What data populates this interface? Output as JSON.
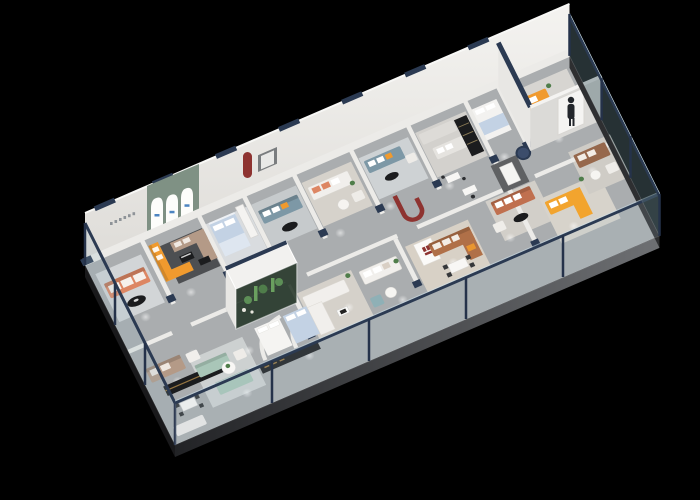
{
  "scene": {
    "description": "3D isometric cutaway rendering of a furniture showroom floor plan on a solid black background",
    "view": "oblique top-down cutaway, long floor plate running from lower-left to upper-right",
    "background_color": "#000000",
    "palette": {
      "bg": "#000000",
      "floor": "#aaadaf",
      "wall": "#ecebe8",
      "wall_shade": "#dbdad7",
      "navy": "#2b3a52",
      "slab_dark": "#222326",
      "slab_light": "#6e7073",
      "orange": "#f09a2e",
      "yellow": "#f2a42e",
      "coral": "#dd8663",
      "taupe": "#b49a87",
      "teal_sofa": "#7d98a6",
      "sage_sofa": "#a9c6b8",
      "sage_wall": "#7f9184",
      "caramel": "#b07048",
      "terracotta": "#c0704f",
      "brown": "#96684c",
      "bed_blue": "#c3d2e4",
      "red": "#8e3330",
      "plant": "#4f7d4a",
      "rug_dark": "#4d4f52",
      "black_furniture": "#1b1c1e",
      "gold": "#c79a4e",
      "white_soft": "#f1efec"
    },
    "building": {
      "perimeter": "frameless glass curtain wall with navy top rail on the front, left and right sides; solid white wall along the back",
      "slab": "dark exposed floor-slab edge below the glass",
      "floor": "light gray with ceiling spotlight pools"
    },
    "back_rooms": [
      "lounge with coral three-seat sofa and black oval coffee table",
      "display bay with sage-green wall and three white arched niches, orange L-sofa and taupe sectional on dark rug",
      "bedroom display with light-blue bed and white wardrobe",
      "lounge with slate-teal sofa, orange cushion and black oval table",
      "lounge with white sofa and coral cushions, round side table",
      "second slate-teal sofa lounge",
      "zone with two light-gray sofas and black shelving rack",
      "bedroom display with white bed and blue blanket",
      "corner room with orange sofa and standing-person poster panel"
    ],
    "front_zones": [
      "taupe sofa with long black media console with gold trim and dining set",
      "sage-green sofa lounge with round white table and plant",
      "central planted glass terrarium with cacti, two bed displays behind curved white part-walls, black console",
      "white L-shaped sectional with square coffee table",
      "white sofa with round table and teal cube ottoman",
      "caramel leather sectional, dining table with four chairs, white panel with red logo marks, dark-red curved ribbon display",
      "dark feature wall with mirror, terracotta sofa, navy cylinder table, yellow L-sofa, brown sofa corner behind glass"
    ],
    "features": {
      "terrarium": "glass case with cactus planting, navy top band",
      "arched_niches": 3,
      "person_figure": true,
      "spotlight_pools": 20,
      "logo_marks": "small illegible blue marks in arches, red block marks on white panel"
    }
  }
}
